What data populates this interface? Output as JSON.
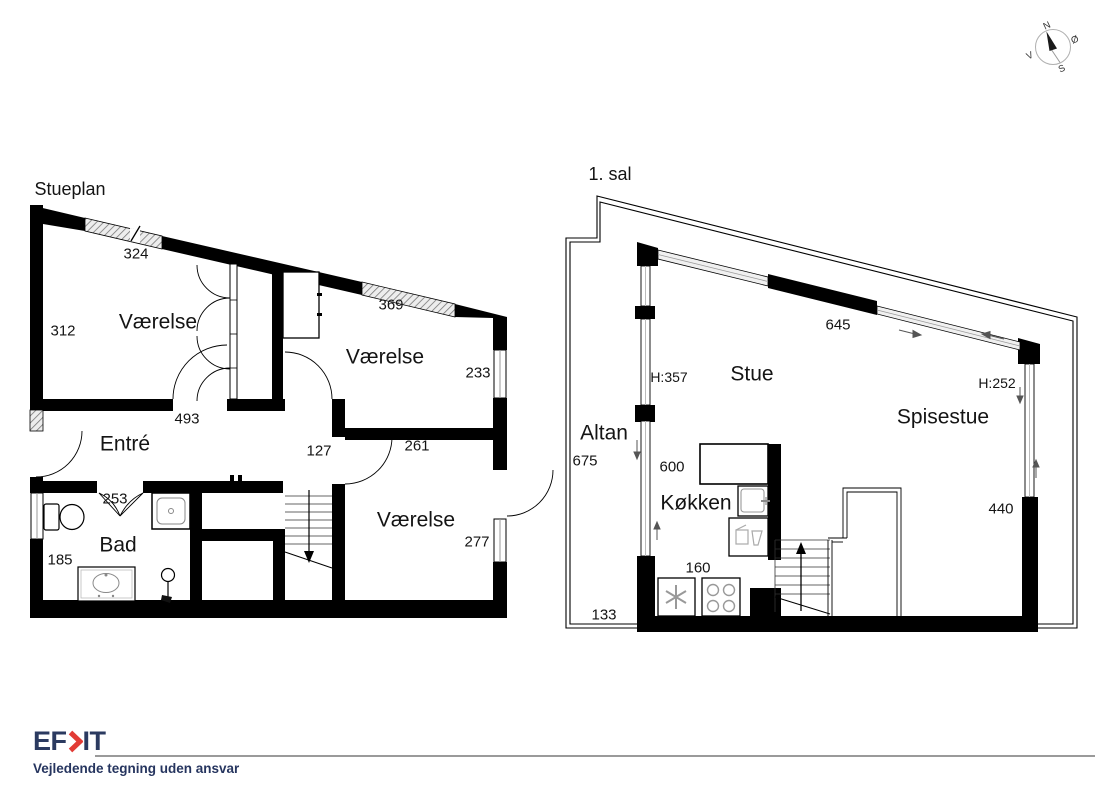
{
  "stueplan": {
    "title": "Stueplan",
    "rooms": {
      "room1": "Værelse",
      "room2": "Værelse",
      "room3": "Værelse",
      "entre": "Entré",
      "bad": "Bad"
    },
    "dims": {
      "d324": "324",
      "d312": "312",
      "d369": "369",
      "d233": "233",
      "d493": "493",
      "d127": "127",
      "d261": "261",
      "d253": "253",
      "d277": "277",
      "d185": "185"
    }
  },
  "sal1": {
    "title": "1. sal",
    "rooms": {
      "stue": "Stue",
      "spisestue": "Spisestue",
      "kokken": "Køkken",
      "altan": "Altan"
    },
    "dims": {
      "d645": "645",
      "h357": "H:357",
      "h252": "H:252",
      "d675": "675",
      "d600": "600",
      "d440": "440",
      "d160": "160",
      "d133": "133"
    }
  },
  "compass": {
    "n": "N",
    "e": "Ø",
    "s": "S",
    "w": "V"
  },
  "footer": {
    "logo_left": "EF",
    "logo_right": "IT",
    "disclaimer": "Vejledende tegning uden ansvar"
  }
}
